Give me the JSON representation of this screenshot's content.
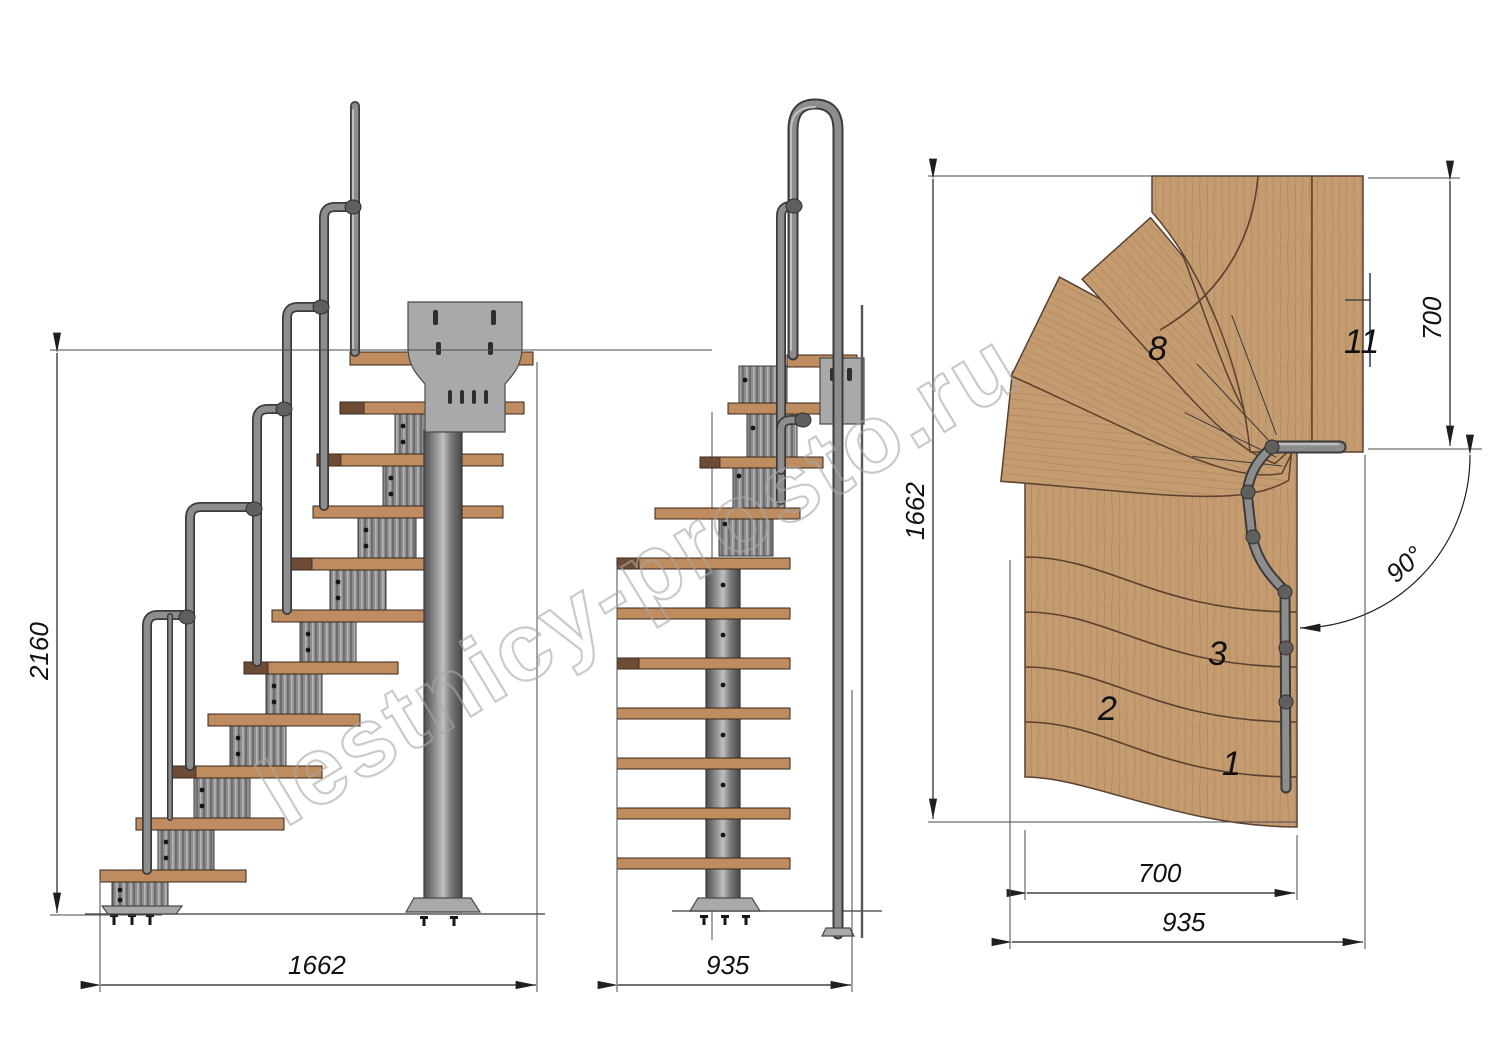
{
  "watermark": "lestnicy-prosto.ru",
  "side_view": {
    "dim_height": "2160",
    "dim_length": "1662"
  },
  "front_view": {
    "dim_width": "935"
  },
  "plan_view": {
    "dim_depth": "1662",
    "dim_exit": "700",
    "dim_run": "700",
    "dim_width": "935",
    "dim_angle": "90°",
    "steps": [
      "1",
      "2",
      "3",
      "8",
      "11"
    ]
  },
  "colors": {
    "background": "#ffffff",
    "wood": "#c59b70",
    "wood_dark": "#6d4b35",
    "metal": "#8e8e8e",
    "metal_dark": "#3b3b3b",
    "plate": "#a9a9a9",
    "dimension": "#1a1a1a",
    "watermark_gray": "#a8a8a8"
  }
}
